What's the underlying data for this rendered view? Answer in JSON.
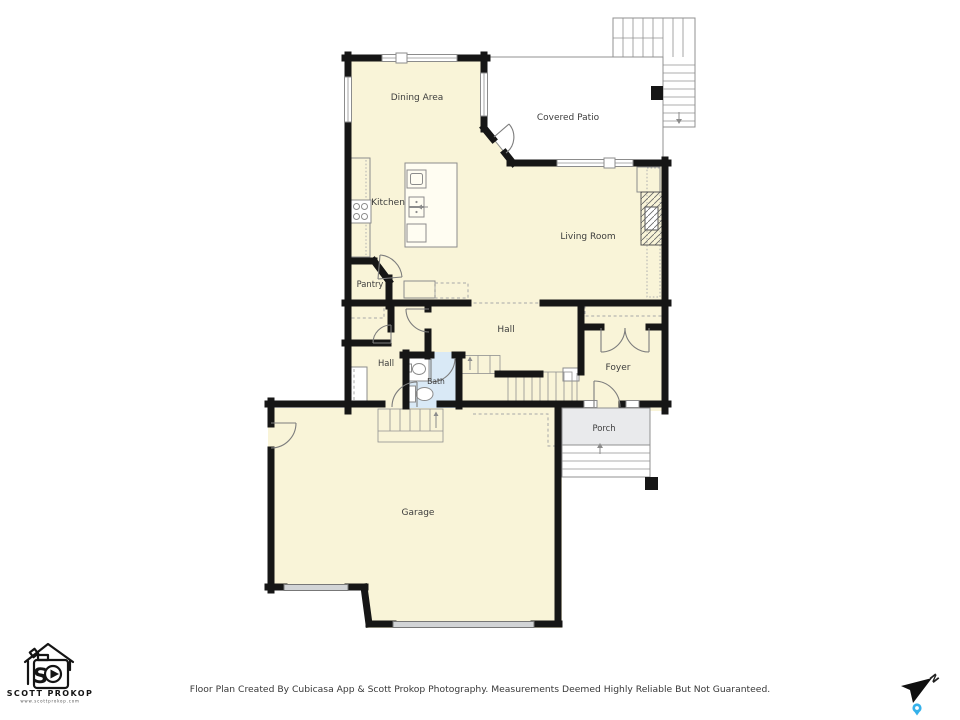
{
  "rooms": {
    "dining_area": "Dining Area",
    "covered_patio": "Covered Patio",
    "kitchen": "Kitchen",
    "living_room": "Living Room",
    "pantry": "Pantry",
    "hall_center": "Hall",
    "hall_left": "Hall",
    "bath": "Bath",
    "foyer": "Foyer",
    "porch": "Porch",
    "garage": "Garage"
  },
  "footer": {
    "disclaimer": "Floor Plan Created By Cubicasa App & Scott Prokop Photography. Measurements Deemed Highly Reliable But Not Guaranteed."
  },
  "logo": {
    "brand": "SCOTT PROKOP",
    "website": "www.scottprokop.com"
  },
  "compass": {
    "north_label": "N"
  },
  "colors": {
    "floor_fill": "#f9f4d8",
    "patio_fill": "#e9eaec",
    "bath_fill": "#d9e9f6",
    "wall_color": "#161616",
    "line_color": "#909090",
    "label_color": "#3d3d3d",
    "steps_fill": "#fbfbfc",
    "garage_door_fill": "#d2d4d6",
    "pin_blue": "#35b1ea"
  }
}
